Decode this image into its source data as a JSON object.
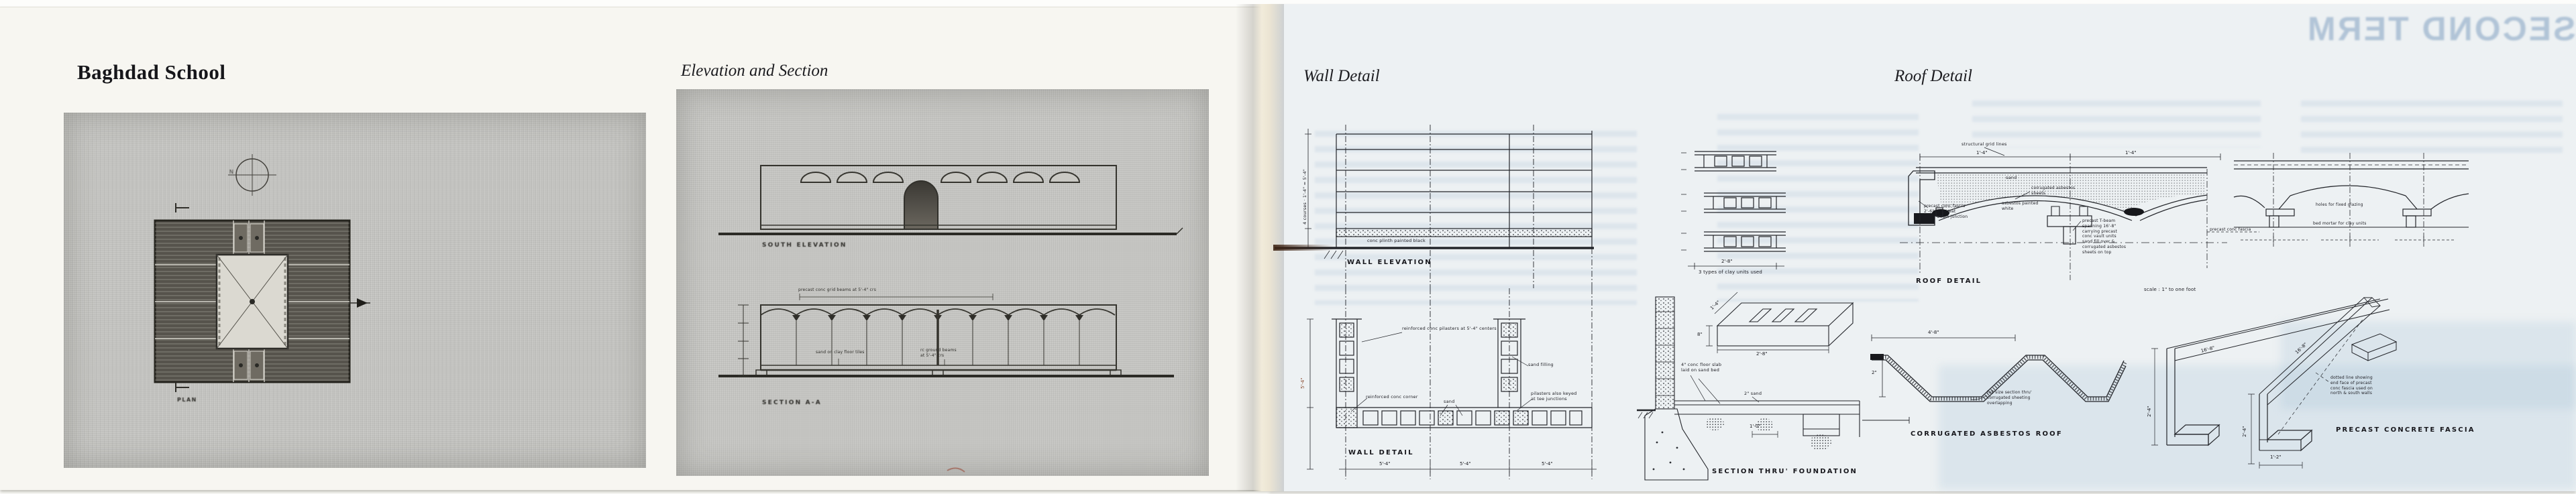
{
  "book": {
    "left_page": {
      "title": "Baghdad School",
      "plan_photo": {
        "north_label": "N",
        "plan_caption": "PLAN"
      }
    },
    "middle": {
      "title": "Elevation and Section",
      "elevation_caption": "SOUTH ELEVATION",
      "section_caption": "SECTION A-A",
      "grid_note": "precast conc grid beams at 5'-4\" crs",
      "floor_note_left": "sand on clay floor tiles",
      "floor_note_right": "rc ground beams\nat 5'-4\" crs"
    },
    "right_page": {
      "wall_title": "Wall Detail",
      "roof_title": "Roof Detail",
      "ghost_headline": "SECOND TERM",
      "wall_elevation": {
        "caption": "WALL ELEVATION",
        "plinth_note": "conc plinth painted black",
        "height_dim": "4 courses · 1'-4\" = 5'-4\""
      },
      "clay_units": {
        "caption": "3 types of clay units used",
        "width_dim": "2'-8\""
      },
      "wall_plan": {
        "caption": "WALL DETAIL",
        "pilaster_note": "reinforced conc pilasters at 5'-4\" centers",
        "corner_note": "reinforced conc corner",
        "sand_fill_note": "sand filling",
        "sand_note": "sand",
        "keyed_note": "pilasters also keyed\nat tee junctions",
        "bay_dim_1": "5'-4\"",
        "bay_dim_2": "5'-4\"",
        "bay_dim_3": "5'-4\"",
        "height_dim": "5'-4\""
      },
      "foundation": {
        "caption": "SECTION THRU' FOUNDATION",
        "slab_note": "4\" conc floor slab\nlaid on sand bed",
        "sand_note": "2\" sand",
        "beam_dim": "1'-0\"",
        "block_width_dim": "2'-8\"",
        "block_height_dim": "8\"",
        "block_depth_dim": "1'-4\""
      },
      "corrugated": {
        "caption": "CORRUGATED ASBESTOS ROOF",
        "width_dim": "4'-8\"",
        "height_dim": "2\"",
        "note": "full size section thru'\ncorrugated sheeting\noverlapping"
      },
      "roof_section": {
        "caption": "ROOF DETAIL",
        "grid_note": "structural grid lines",
        "bay_dim_1": "1'-4\"",
        "bay_dim_2": "1'-4\"",
        "sand_note": "sand",
        "sheet_note": "corrugated asbestos\nsheets",
        "painted_note": "asbestos painted\nwhite",
        "fascia_note": "precast conc fascia\n2'-6\" lg to seat\nend T-beam junction",
        "tbeam_note": "precast T-beam\nspanning 16'-8\"\ncarrying precast\nconc vault units\nsand fill over &\ncorrugated asbestos\nsheets on top",
        "scale_note": "scale : 1\" to one foot"
      },
      "roof_underside": {
        "glazing_note": "holes for fixed glazing",
        "units_note": "bed mortar for clay units",
        "fascia_note": "precast conc fascia"
      },
      "fascia": {
        "caption": "PRECAST CONCRETE FASCIA",
        "length_dim": "16'-8\"",
        "length_dim_2": "16'-8\"",
        "height_dim": "2'-4\"",
        "height_dim_2": "2'-4\"",
        "base_dim": "1'-2\"",
        "note": "dotted line showing\nend face of precast\nconc fascia used on\nnorth & south walls"
      }
    }
  }
}
